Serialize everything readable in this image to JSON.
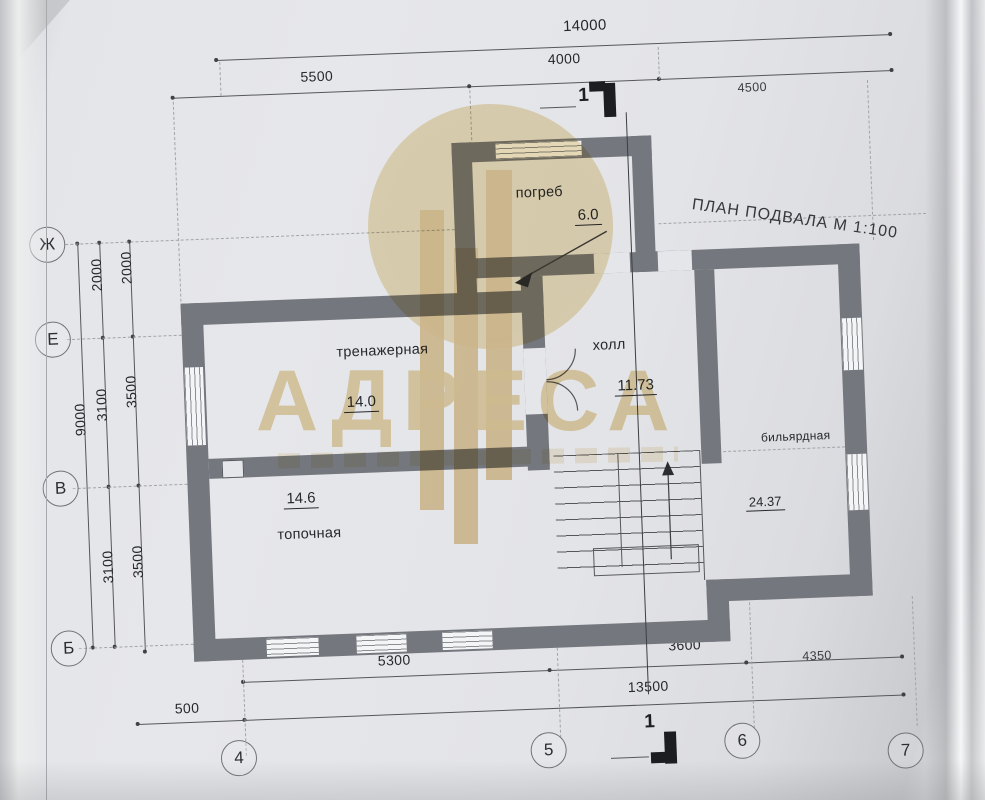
{
  "title": "ПЛАН ПОДВАЛА  М 1:100",
  "watermark": {
    "brand": "АДРЕСА"
  },
  "rooms": [
    {
      "name": "погреб",
      "area": "6.0"
    },
    {
      "name": "тренажерная",
      "area": "14.0"
    },
    {
      "name": "холл",
      "area": "11.73"
    },
    {
      "name": "топочная",
      "area": "14.6"
    },
    {
      "name": "бильярдная",
      "area": "24.37"
    }
  ],
  "dims": {
    "top_total": "14000",
    "top_left": "5500",
    "top_mid": "4000",
    "top_right": "4500",
    "left_total": "9000",
    "left_inner_top": "2000",
    "left_inner_mid": "3100",
    "left_inner_bot": "3100",
    "left_outer_top": "2000",
    "left_outer_mid": "3500",
    "left_outer_bot": "3500",
    "edge_fragment": "00",
    "bottom_left": "5300",
    "bottom_mid": "3600",
    "bottom_right": "4350",
    "bottom_total": "13500",
    "bottom_offset": "500"
  },
  "axes": {
    "rows": [
      "Ж",
      "Е",
      "В",
      "Б"
    ],
    "cols": [
      "4",
      "5",
      "6",
      "7"
    ]
  },
  "section": {
    "label": "1"
  },
  "colors": {
    "wall": "#74777d",
    "paper": "#e4e5e9",
    "watermark_beige": "#e6cf9c",
    "line": "#55575b"
  }
}
